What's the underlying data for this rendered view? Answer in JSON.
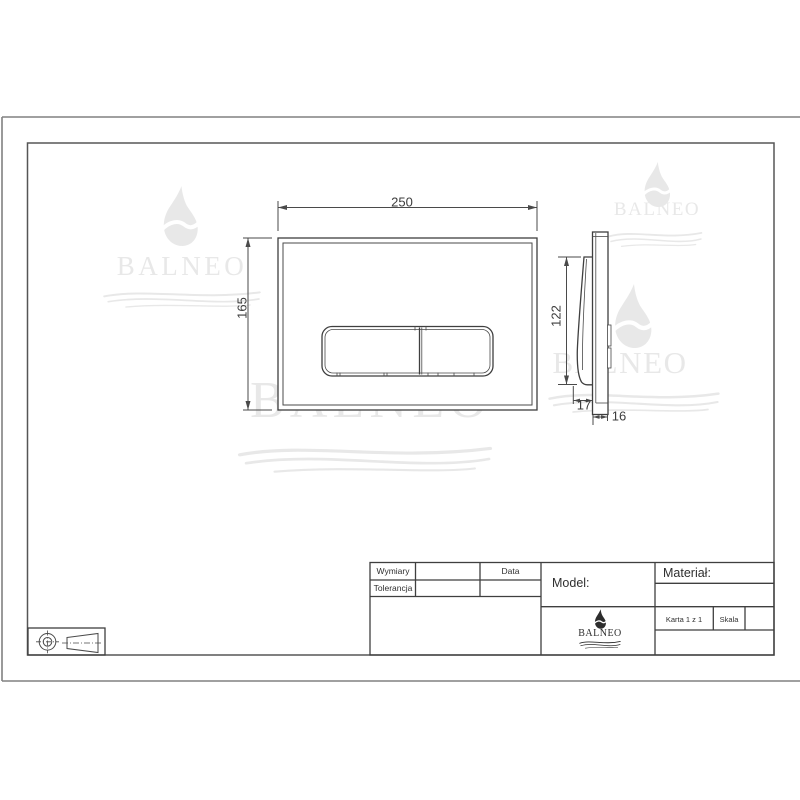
{
  "colors": {
    "line": "#3f3f3f",
    "dim": "#4a4a4a",
    "frame_outer": "#818181",
    "frame_inner": "#565656",
    "watermark": "#e8e8e8",
    "logo_dark": "#2d2d2d"
  },
  "brand": {
    "name": "BALNEO"
  },
  "views": {
    "front": {
      "width_mm": "250",
      "height_mm": "165"
    },
    "side": {
      "height_mm": "122",
      "button_depth_mm": "17",
      "thickness_mm": "16"
    }
  },
  "title_block": {
    "dimensions_label": "Wymiary",
    "date_label": "Data",
    "tolerance_label": "Tolerancja",
    "model_label": "Model:",
    "material_label": "Materiał:",
    "sheet_label": "Karta 1 z 1",
    "scale_label": "Skala"
  },
  "icons": {
    "projection": "first-angle-projection",
    "brand_mark": "balneo-flame",
    "brand_waves": "balneo-waves"
  }
}
